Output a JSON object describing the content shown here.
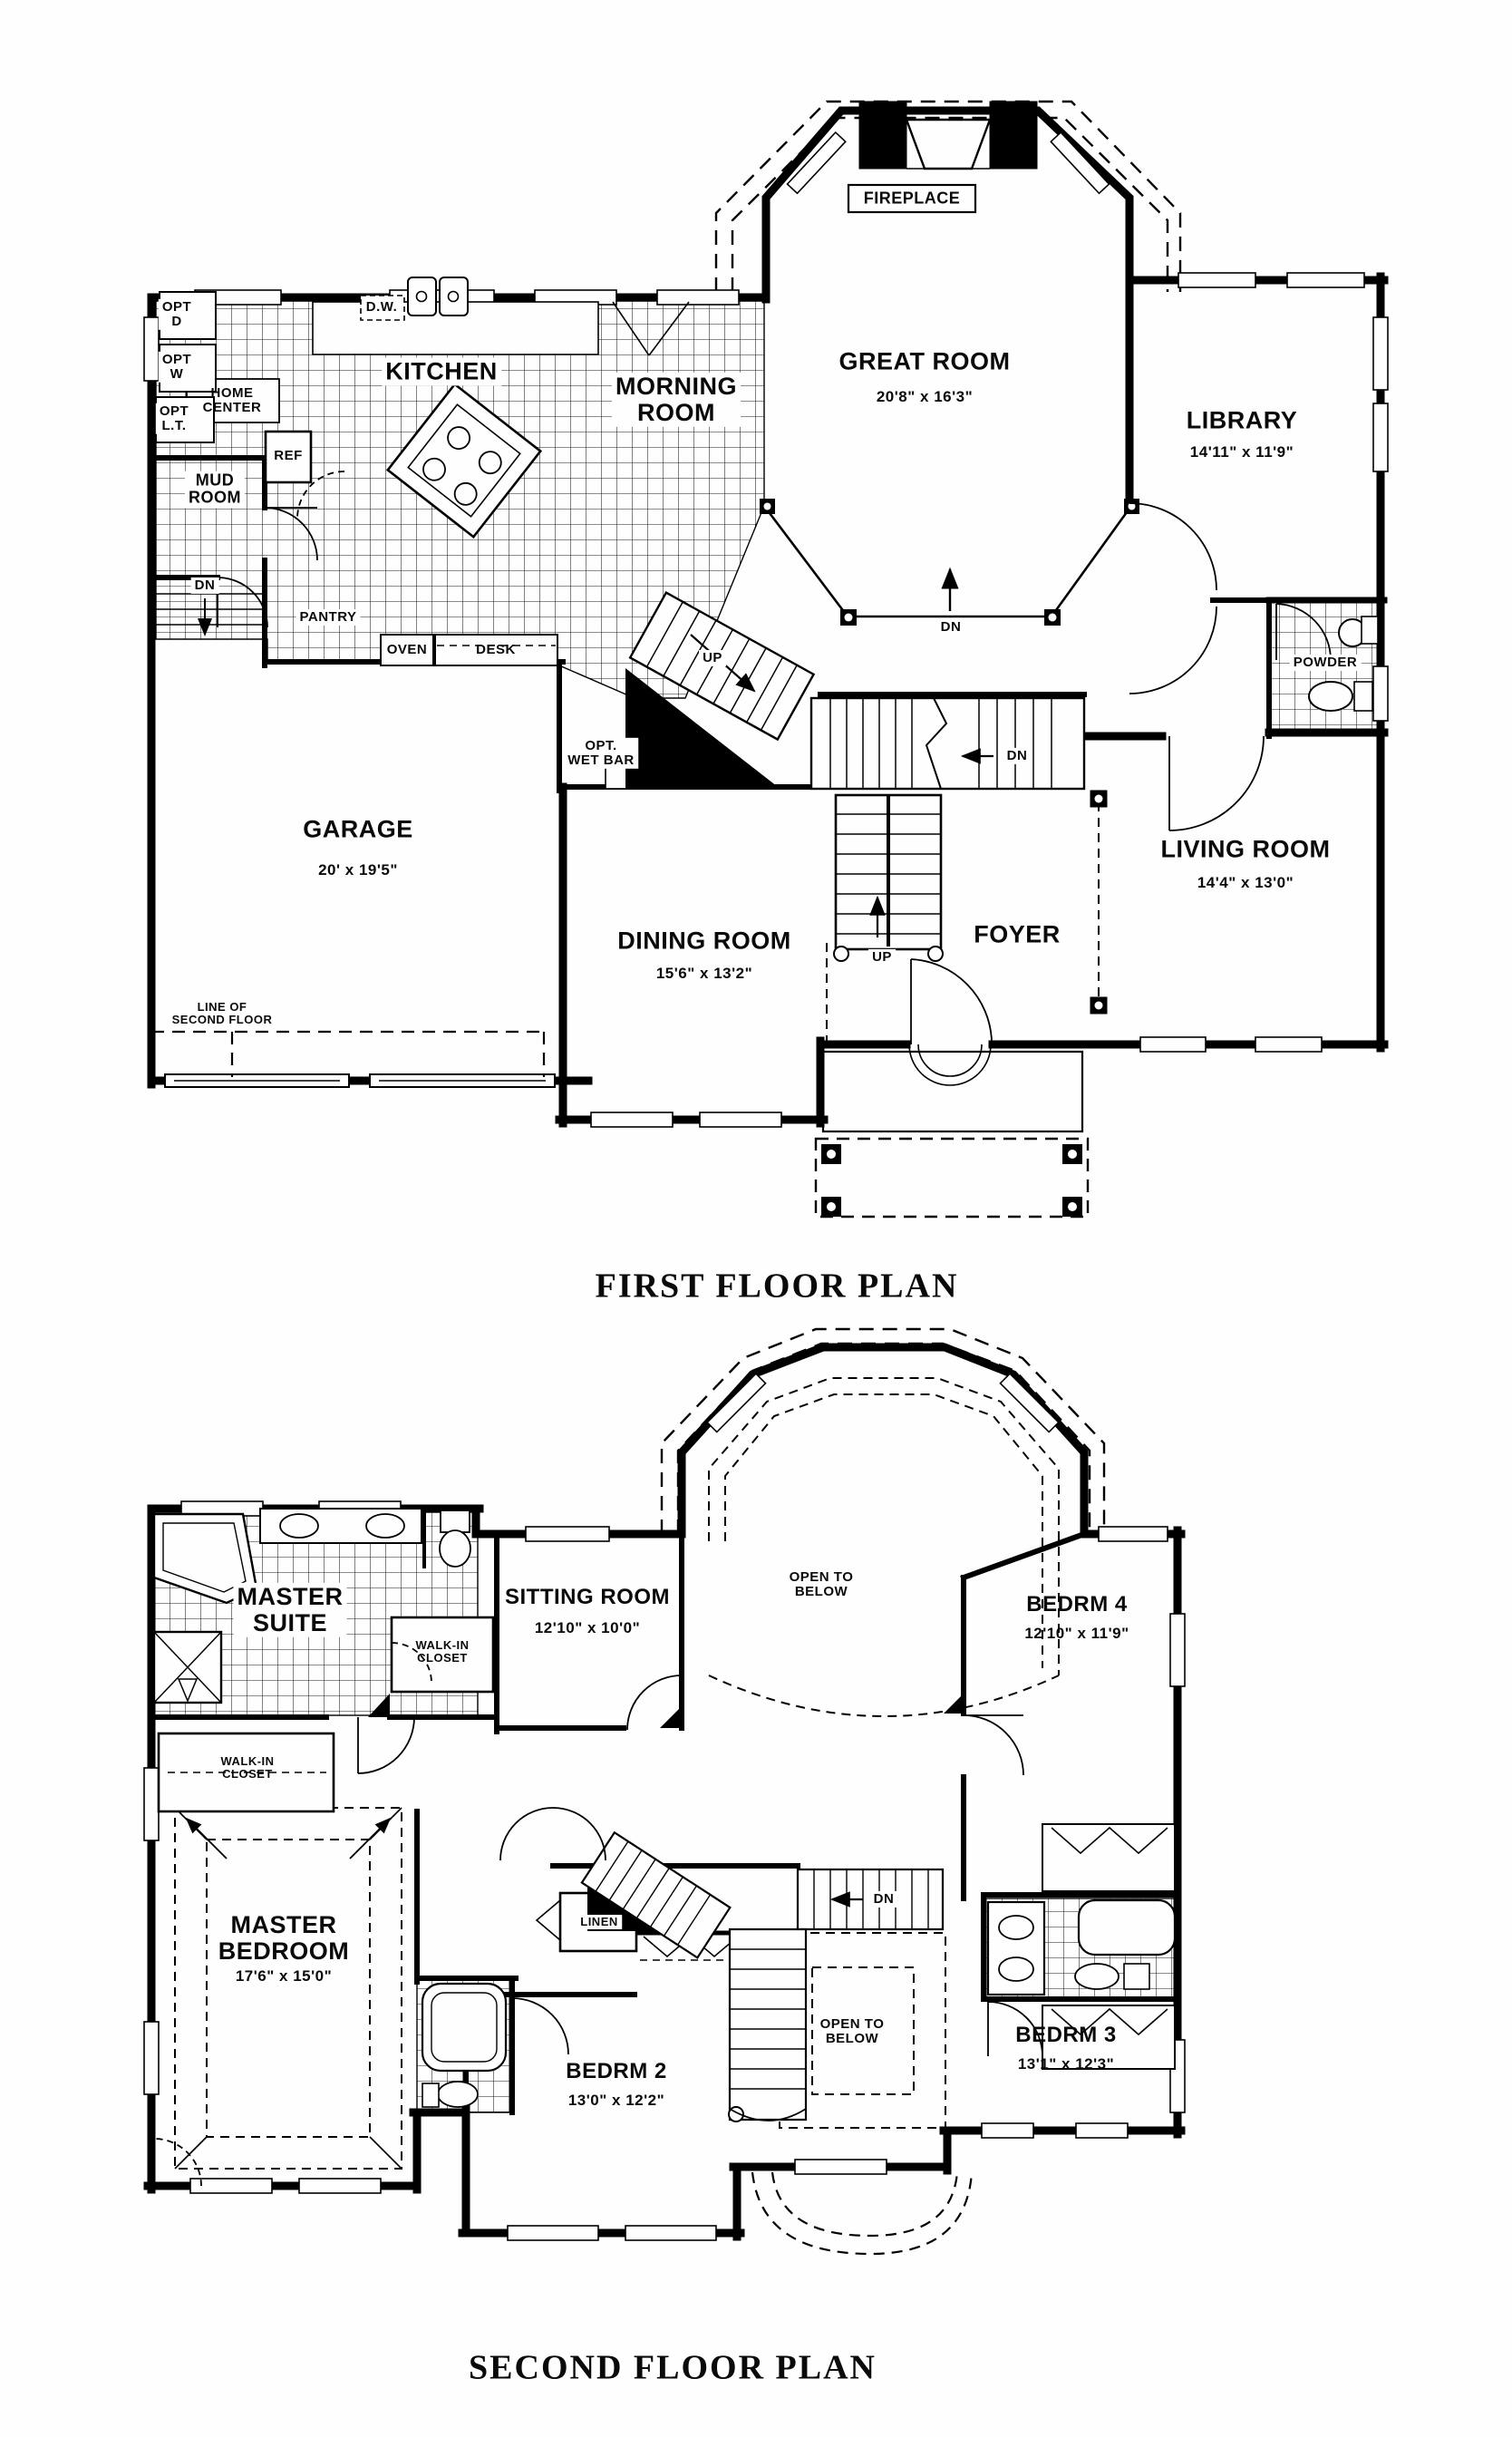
{
  "page": {
    "background": "#fefefe",
    "ink": "#0a0a0a"
  },
  "first_floor": {
    "title": "FIRST FLOOR PLAN",
    "rooms": {
      "kitchen": {
        "label": "KITCHEN"
      },
      "morning_room": {
        "label": "MORNING\nROOM"
      },
      "great_room": {
        "label": "GREAT ROOM",
        "dims": "20'8\" x 16'3\""
      },
      "library": {
        "label": "LIBRARY",
        "dims": "14'11\" x 11'9\""
      },
      "garage": {
        "label": "GARAGE",
        "dims": "20' x 19'5\""
      },
      "dining_room": {
        "label": "DINING ROOM",
        "dims": "15'6\" x 13'2\""
      },
      "living_room": {
        "label": "LIVING ROOM",
        "dims": "14'4\" x 13'0\""
      },
      "foyer": {
        "label": "FOYER"
      },
      "mud_room": {
        "label": "MUD\nROOM"
      },
      "powder": {
        "label": "POWDER"
      },
      "fireplace": {
        "label": "FIREPLACE"
      }
    },
    "features": {
      "opt_dryer": "OPT\nD",
      "opt_washer": "OPT\nW",
      "opt_laundry_tub": "OPT\nL.T.",
      "home_center": "HOME\nCENTER",
      "dishwasher": "D.W.",
      "refrigerator": "REF",
      "pantry": "PANTRY",
      "oven": "OVEN",
      "desk": "DESK",
      "opt_wet_bar": "OPT.\nWET BAR",
      "line_of_second_floor": "LINE OF\nSECOND FLOOR"
    },
    "stairs": {
      "up_back": "UP",
      "dn_back": "DN",
      "up_main": "UP",
      "dn_mud": "DN",
      "dn_great": "DN"
    }
  },
  "second_floor": {
    "title": "SECOND FLOOR PLAN",
    "rooms": {
      "master_suite": {
        "label": "MASTER\nSUITE"
      },
      "master_bedroom": {
        "label": "MASTER\nBEDROOM",
        "dims": "17'6\" x 15'0\""
      },
      "sitting_room": {
        "label": "SITTING ROOM",
        "dims": "12'10\" x 10'0\""
      },
      "bedrm_2": {
        "label": "BEDRM 2",
        "dims": "13'0\" x 12'2\""
      },
      "bedrm_3": {
        "label": "BEDRM 3",
        "dims": "13'1\" x 12'3\""
      },
      "bedrm_4": {
        "label": "BEDRM 4",
        "dims": "12'10\" x 11'9\""
      }
    },
    "features": {
      "walk_in_closet_upper": "WALK-IN\nCLOSET",
      "walk_in_closet_lower": "WALK-IN\nCLOSET",
      "open_to_below_great": "OPEN TO\nBELOW",
      "open_to_below_foyer": "OPEN TO\nBELOW",
      "linen": "LINEN"
    },
    "stairs": {
      "dn": "DN"
    }
  }
}
